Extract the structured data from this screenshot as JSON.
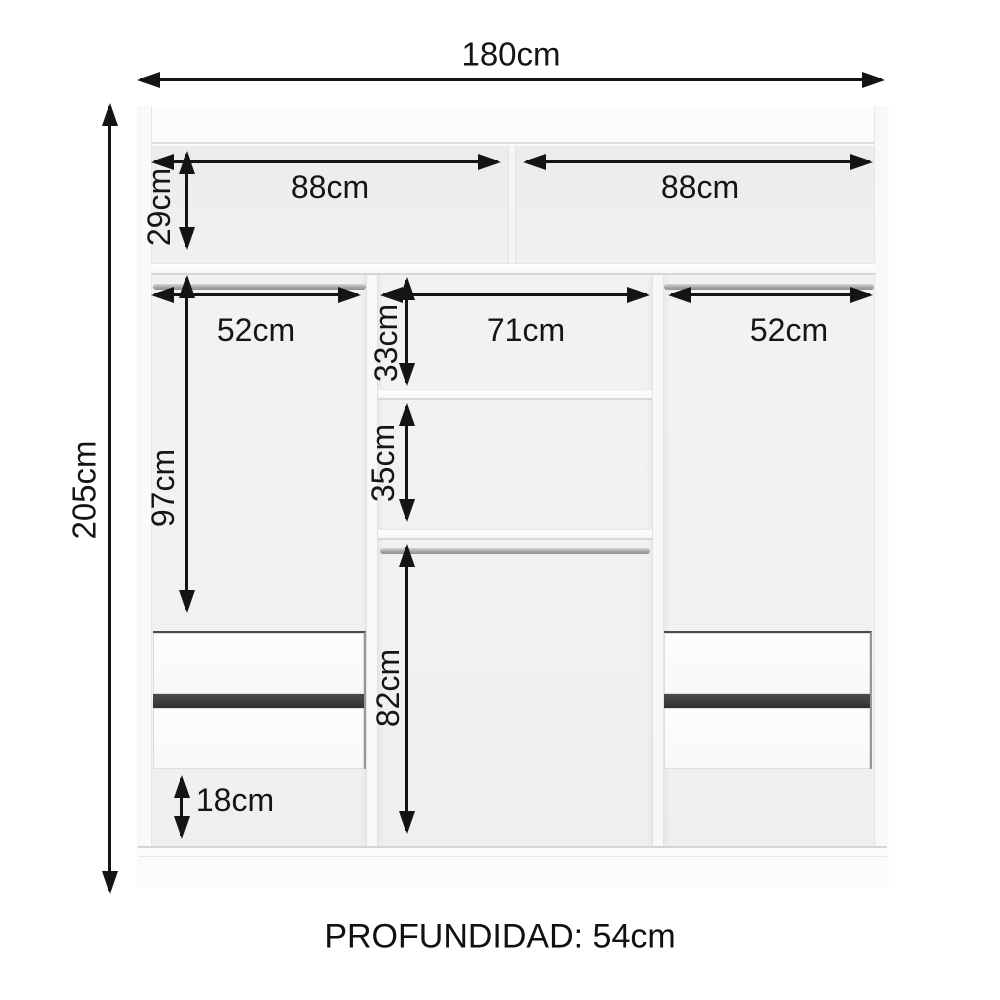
{
  "diagram": {
    "type": "wardrobe-interior-dimension-diagram",
    "labels": {
      "overall_width": "180cm",
      "overall_height": "205cm",
      "top_shelf_left_width": "88cm",
      "top_shelf_right_width": "88cm",
      "top_section_height": "29cm",
      "left_section_width": "52cm",
      "center_section_width": "71cm",
      "right_section_width": "52cm",
      "left_hanging_height": "97cm",
      "center_upper_compartment_height": "33cm",
      "center_middle_compartment_height": "35cm",
      "center_lower_compartment_height": "82cm",
      "bottom_left_compartment_height": "18cm",
      "depth_note": "PROFUNDIDAD: 54cm"
    },
    "colors": {
      "line": "#141414",
      "cabinet": "#fafaf8",
      "interior": "#f0f0ee",
      "drawer_gap": "#3e3e3c",
      "rod": "#a8a8a6"
    }
  }
}
